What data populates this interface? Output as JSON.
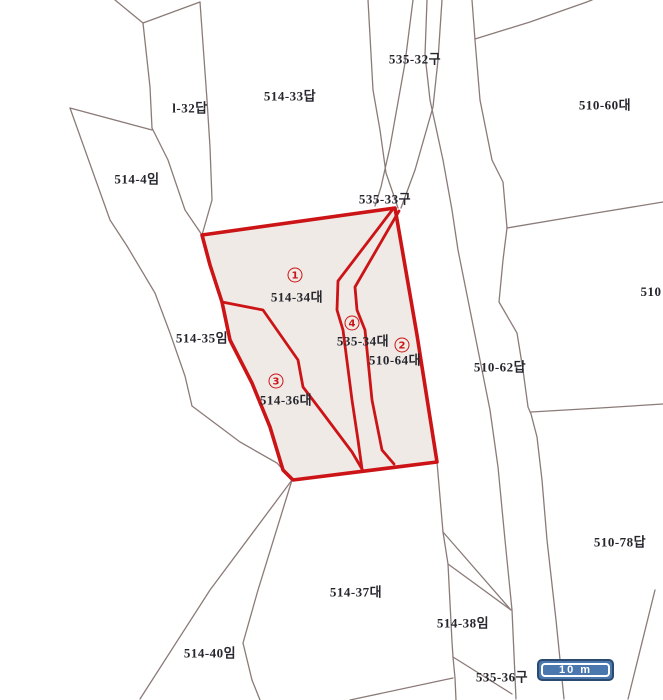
{
  "map": {
    "type": "cadastral-parcel-map",
    "colors": {
      "background": "#ffffff",
      "parcel_line": "#8b7b78",
      "highlight_stroke": "#cc1417",
      "highlight_fill": "#efeae5",
      "label_text": "#26262e",
      "scalebar_fill": "#4a77ad",
      "scalebar_border": "#2a4a72"
    },
    "labels": {
      "l32": {
        "text": "l-32답"
      },
      "p51433": {
        "text": "514-33답"
      },
      "p53532": {
        "text": "535-32구"
      },
      "p51060": {
        "text": "510-60대"
      },
      "p5144": {
        "text": "514-4임"
      },
      "p53533": {
        "text": "535-33구"
      },
      "p51435": {
        "text": "514-35임"
      },
      "p510": {
        "text": "510"
      },
      "p51062": {
        "text": "510-62답"
      },
      "p51078": {
        "text": "510-78답"
      },
      "p51437": {
        "text": "514-37대"
      },
      "p51438": {
        "text": "514-38임"
      },
      "p51440": {
        "text": "514-40임"
      },
      "p53536": {
        "text": "535-36구"
      },
      "p51434": {
        "text": "514-34대"
      },
      "p53534": {
        "text": "535-34대"
      },
      "p51064": {
        "text": "510-64대"
      },
      "p51436": {
        "text": "514-36대"
      }
    },
    "markers": {
      "m1": {
        "n": "1",
        "parcel": "514-34대"
      },
      "m2": {
        "n": "2",
        "parcel": "510-64대"
      },
      "m3": {
        "n": "3",
        "parcel": "514-36대"
      },
      "m4": {
        "n": "4",
        "parcel": "535-34대"
      }
    },
    "scalebar": {
      "text": "10 m"
    }
  }
}
